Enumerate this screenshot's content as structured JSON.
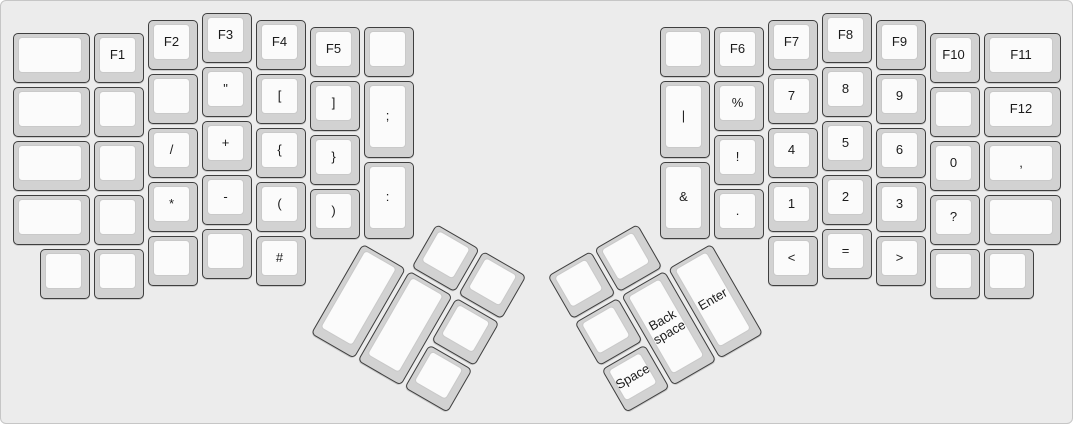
{
  "keyboard": {
    "description": "Ergodox split keyboard layout, symbols and function layer",
    "unit_px": 54,
    "key_inset_px": 2,
    "colors": {
      "canvas_bg": "#ececec",
      "canvas_border": "#c6c6c6",
      "key_side": "#d2d2d2",
      "key_border": "#3f3f3f",
      "key_top": "#fbfbfb",
      "key_top_border": "#c9c9c9",
      "label": "#1b1b1b"
    },
    "groups": [
      {
        "name": "left-main",
        "origin_x": 10,
        "origin_y": 10,
        "rotation_deg": 0,
        "keys": [
          {
            "x": 0,
            "y": 0.375,
            "w": 1.5,
            "h": 1,
            "label": ""
          },
          {
            "x": 1.5,
            "y": 0.375,
            "w": 1,
            "h": 1,
            "label": "F1"
          },
          {
            "x": 2.5,
            "y": 0.125,
            "w": 1,
            "h": 1,
            "label": "F2"
          },
          {
            "x": 3.5,
            "y": 0,
            "w": 1,
            "h": 1,
            "label": "F3"
          },
          {
            "x": 4.5,
            "y": 0.125,
            "w": 1,
            "h": 1,
            "label": "F4"
          },
          {
            "x": 5.5,
            "y": 0.25,
            "w": 1,
            "h": 1,
            "label": "F5"
          },
          {
            "x": 6.5,
            "y": 0.25,
            "w": 1,
            "h": 1,
            "label": ""
          },
          {
            "x": 0,
            "y": 1.375,
            "w": 1.5,
            "h": 1,
            "label": ""
          },
          {
            "x": 1.5,
            "y": 1.375,
            "w": 1,
            "h": 1,
            "label": ""
          },
          {
            "x": 2.5,
            "y": 1.125,
            "w": 1,
            "h": 1,
            "label": ""
          },
          {
            "x": 3.5,
            "y": 1,
            "w": 1,
            "h": 1,
            "label": "\""
          },
          {
            "x": 4.5,
            "y": 1.125,
            "w": 1,
            "h": 1,
            "label": "["
          },
          {
            "x": 5.5,
            "y": 1.25,
            "w": 1,
            "h": 1,
            "label": "]"
          },
          {
            "x": 6.5,
            "y": 1.25,
            "w": 1,
            "h": 1.5,
            "label": ";"
          },
          {
            "x": 0,
            "y": 2.375,
            "w": 1.5,
            "h": 1,
            "label": ""
          },
          {
            "x": 1.5,
            "y": 2.375,
            "w": 1,
            "h": 1,
            "label": ""
          },
          {
            "x": 2.5,
            "y": 2.125,
            "w": 1,
            "h": 1,
            "label": "/"
          },
          {
            "x": 3.5,
            "y": 2,
            "w": 1,
            "h": 1,
            "label": "+"
          },
          {
            "x": 4.5,
            "y": 2.125,
            "w": 1,
            "h": 1,
            "label": "{"
          },
          {
            "x": 5.5,
            "y": 2.25,
            "w": 1,
            "h": 1,
            "label": "}"
          },
          {
            "x": 6.5,
            "y": 2.75,
            "w": 1,
            "h": 1.5,
            "label": ":"
          },
          {
            "x": 0,
            "y": 3.375,
            "w": 1.5,
            "h": 1,
            "label": ""
          },
          {
            "x": 1.5,
            "y": 3.375,
            "w": 1,
            "h": 1,
            "label": ""
          },
          {
            "x": 2.5,
            "y": 3.125,
            "w": 1,
            "h": 1,
            "label": "*"
          },
          {
            "x": 3.5,
            "y": 3,
            "w": 1,
            "h": 1,
            "label": "-"
          },
          {
            "x": 4.5,
            "y": 3.125,
            "w": 1,
            "h": 1,
            "label": "("
          },
          {
            "x": 5.5,
            "y": 3.25,
            "w": 1,
            "h": 1,
            "label": ")"
          },
          {
            "x": 0.5,
            "y": 4.375,
            "w": 1,
            "h": 1,
            "label": ""
          },
          {
            "x": 1.5,
            "y": 4.375,
            "w": 1,
            "h": 1,
            "label": ""
          },
          {
            "x": 2.5,
            "y": 4.125,
            "w": 1,
            "h": 1,
            "label": ""
          },
          {
            "x": 3.5,
            "y": 4,
            "w": 1,
            "h": 1,
            "label": ""
          },
          {
            "x": 4.5,
            "y": 4.125,
            "w": 1,
            "h": 1,
            "label": "#"
          }
        ]
      },
      {
        "name": "right-main",
        "origin_x": 657,
        "origin_y": 10,
        "rotation_deg": 0,
        "keys": [
          {
            "x": 0,
            "y": 0.25,
            "w": 1,
            "h": 1,
            "label": ""
          },
          {
            "x": 1,
            "y": 0.25,
            "w": 1,
            "h": 1,
            "label": "F6"
          },
          {
            "x": 2,
            "y": 0.125,
            "w": 1,
            "h": 1,
            "label": "F7"
          },
          {
            "x": 3,
            "y": 0,
            "w": 1,
            "h": 1,
            "label": "F8"
          },
          {
            "x": 4,
            "y": 0.125,
            "w": 1,
            "h": 1,
            "label": "F9"
          },
          {
            "x": 5,
            "y": 0.375,
            "w": 1,
            "h": 1,
            "label": "F10"
          },
          {
            "x": 6,
            "y": 0.375,
            "w": 1.5,
            "h": 1,
            "label": "F11"
          },
          {
            "x": 0,
            "y": 1.25,
            "w": 1,
            "h": 1.5,
            "label": "|"
          },
          {
            "x": 1,
            "y": 1.25,
            "w": 1,
            "h": 1,
            "label": "%"
          },
          {
            "x": 2,
            "y": 1.125,
            "w": 1,
            "h": 1,
            "label": "7"
          },
          {
            "x": 3,
            "y": 1,
            "w": 1,
            "h": 1,
            "label": "8"
          },
          {
            "x": 4,
            "y": 1.125,
            "w": 1,
            "h": 1,
            "label": "9"
          },
          {
            "x": 5,
            "y": 1.375,
            "w": 1,
            "h": 1,
            "label": ""
          },
          {
            "x": 6,
            "y": 1.375,
            "w": 1.5,
            "h": 1,
            "label": "F12"
          },
          {
            "x": 0,
            "y": 2.75,
            "w": 1,
            "h": 1.5,
            "label": "&"
          },
          {
            "x": 1,
            "y": 2.25,
            "w": 1,
            "h": 1,
            "label": "!"
          },
          {
            "x": 2,
            "y": 2.125,
            "w": 1,
            "h": 1,
            "label": "4"
          },
          {
            "x": 3,
            "y": 2,
            "w": 1,
            "h": 1,
            "label": "5"
          },
          {
            "x": 4,
            "y": 2.125,
            "w": 1,
            "h": 1,
            "label": "6"
          },
          {
            "x": 5,
            "y": 2.375,
            "w": 1,
            "h": 1,
            "label": "0"
          },
          {
            "x": 6,
            "y": 2.375,
            "w": 1.5,
            "h": 1,
            "label": ","
          },
          {
            "x": 1,
            "y": 3.25,
            "w": 1,
            "h": 1,
            "label": "."
          },
          {
            "x": 2,
            "y": 3.125,
            "w": 1,
            "h": 1,
            "label": "1"
          },
          {
            "x": 3,
            "y": 3,
            "w": 1,
            "h": 1,
            "label": "2"
          },
          {
            "x": 4,
            "y": 3.125,
            "w": 1,
            "h": 1,
            "label": "3"
          },
          {
            "x": 5,
            "y": 3.375,
            "w": 1,
            "h": 1,
            "label": "?"
          },
          {
            "x": 6,
            "y": 3.375,
            "w": 1.5,
            "h": 1,
            "label": ""
          },
          {
            "x": 2,
            "y": 4.125,
            "w": 1,
            "h": 1,
            "label": "<"
          },
          {
            "x": 3,
            "y": 4,
            "w": 1,
            "h": 1,
            "label": "="
          },
          {
            "x": 4,
            "y": 4.125,
            "w": 1,
            "h": 1,
            "label": ">"
          },
          {
            "x": 5,
            "y": 4.375,
            "w": 1,
            "h": 1,
            "label": ""
          },
          {
            "x": 6,
            "y": 4.375,
            "w": 1,
            "h": 1,
            "label": ""
          }
        ]
      },
      {
        "name": "left-thumb",
        "origin_x": 361,
        "origin_y": 239.5,
        "rotation_deg": 30,
        "keys": [
          {
            "x": 1,
            "y": -1,
            "w": 1,
            "h": 1,
            "label": ""
          },
          {
            "x": 2,
            "y": -1,
            "w": 1,
            "h": 1,
            "label": ""
          },
          {
            "x": 0,
            "y": 0,
            "w": 1,
            "h": 2,
            "label": ""
          },
          {
            "x": 1,
            "y": 0,
            "w": 1,
            "h": 2,
            "label": ""
          },
          {
            "x": 2,
            "y": 0,
            "w": 1,
            "h": 1,
            "label": ""
          },
          {
            "x": 2,
            "y": 1,
            "w": 1,
            "h": 1,
            "label": ""
          }
        ]
      },
      {
        "name": "right-thumb",
        "origin_x": 711,
        "origin_y": 239.5,
        "rotation_deg": -30,
        "keys": [
          {
            "x": -3,
            "y": -1,
            "w": 1,
            "h": 1,
            "label": ""
          },
          {
            "x": -2,
            "y": -1,
            "w": 1,
            "h": 1,
            "label": ""
          },
          {
            "x": -3,
            "y": 0,
            "w": 1,
            "h": 1,
            "label": ""
          },
          {
            "x": -2,
            "y": 0,
            "w": 1,
            "h": 2,
            "label": "Back\nspace"
          },
          {
            "x": -1,
            "y": 0,
            "w": 1,
            "h": 2,
            "label": "Enter"
          },
          {
            "x": -3,
            "y": 1,
            "w": 1,
            "h": 1,
            "label": "Space"
          }
        ]
      }
    ]
  }
}
